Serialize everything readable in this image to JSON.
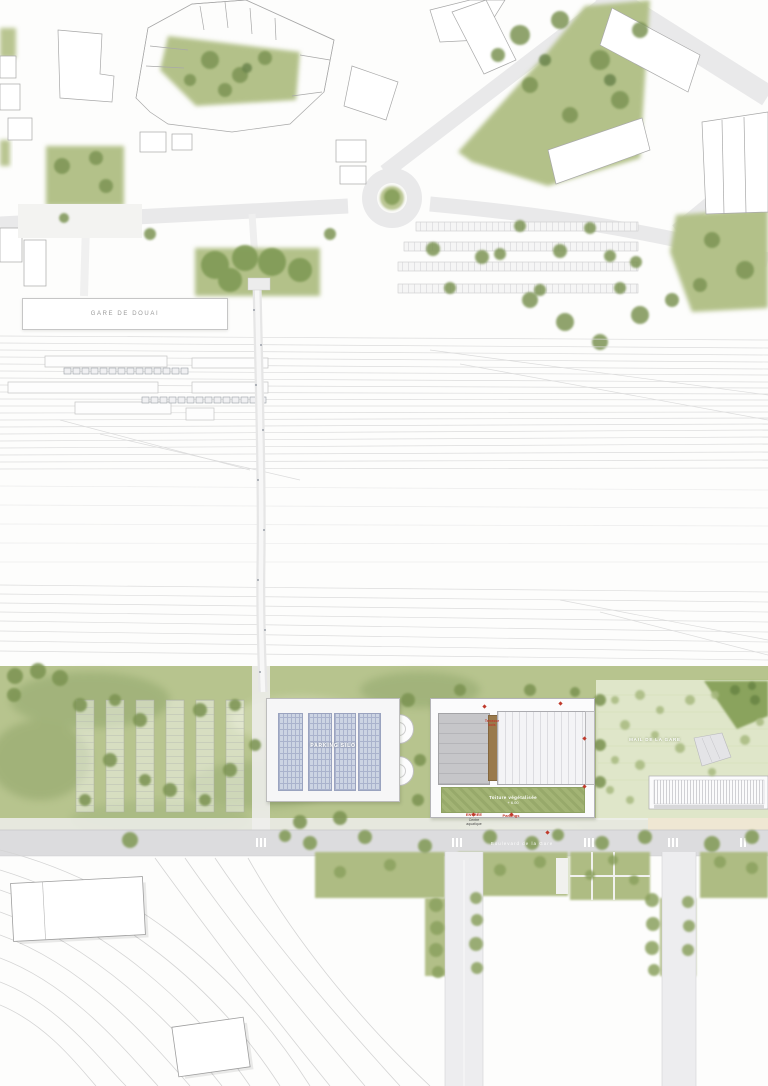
{
  "labels": {
    "station": "GARE DE DOUAI",
    "parking_silo": "PARKING SILO",
    "wood_terrace_1": "Terrasse",
    "wood_terrace_2": "bois",
    "green_roof_1": "Toiture végétalisée",
    "green_roof_2": "+ 6.00",
    "entrance": "ENTRÉE",
    "entrance_sub_1": "Centre",
    "entrance_sub_2": "aquatique",
    "parkings": "Parkings",
    "esplanade": "MAIL DE LA GARE",
    "street": "Boulevard de la Gare"
  },
  "colors": {
    "green_area": "#b5c38b",
    "green_dark": "#7f9a55",
    "esplanade": "#dfe6c9",
    "street_gray": "#e8e8ea",
    "track_gray": "#dcdcdc",
    "pv_panel": "#ccd4e3",
    "wood": "#9a7a4c",
    "green_roof": "#a3b475",
    "marker_red": "#c0392b"
  }
}
